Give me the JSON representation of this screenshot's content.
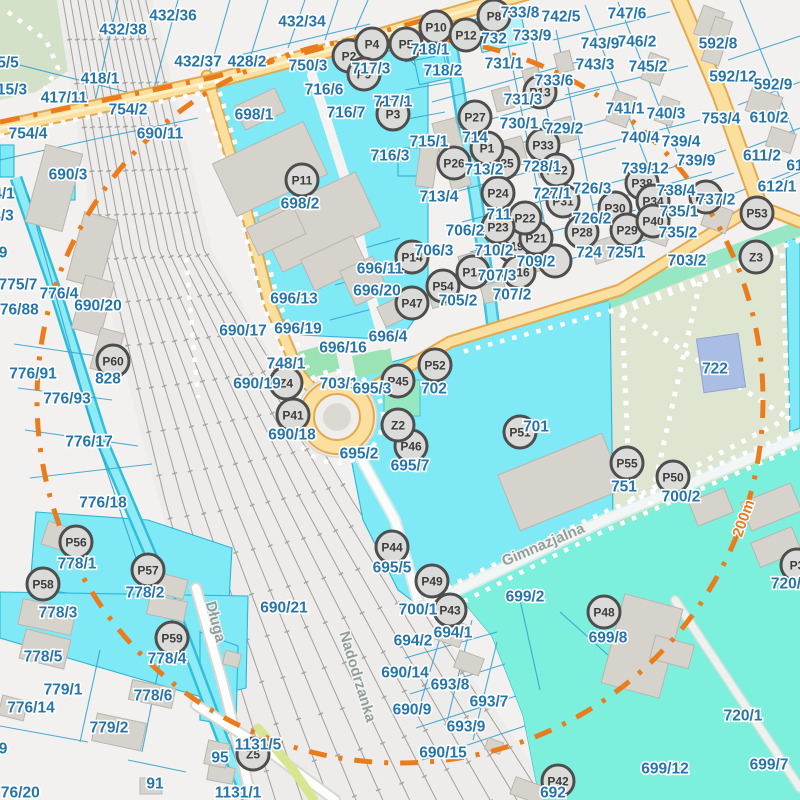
{
  "map": {
    "colors": {
      "background": "#f2f1ef",
      "parcel_cyan": "#7fe9f5",
      "parcel_aqua": "#7cefdd",
      "water_stream": "#8eeaf4",
      "road_yellow": "#fbdf9e",
      "road_casing": "#e5a94e",
      "park_green": "#dee6d2",
      "mint_green": "#97e7c4",
      "building_gray": "#d6d2cc",
      "cadastral_line_blue": "#2f9fca",
      "label_blue": "#2575ab",
      "boundary_orange": "#ea7c1c",
      "marker_fill": "#dbdbda",
      "marker_ring": "#4e4e4e",
      "pond_blue": "#aabde5"
    },
    "street_names": [
      {
        "text": "Długa",
        "x": 211,
        "y": 623,
        "rot": 75
      },
      {
        "text": "Nadodrzanka",
        "x": 353,
        "y": 678,
        "rot": 73
      },
      {
        "text": "Gimnazjalna",
        "x": 545,
        "y": 549,
        "rot": -23
      }
    ],
    "distance_label": {
      "text": "200m",
      "x": 748,
      "y": 520,
      "rot": -70
    },
    "markers": [
      {
        "id": "P2",
        "x": 349,
        "y": 56
      },
      {
        "id": "P4",
        "x": 372,
        "y": 44
      },
      {
        "id": "P5",
        "x": 406,
        "y": 44
      },
      {
        "id": "P8",
        "x": 494,
        "y": 16
      },
      {
        "id": "P10",
        "x": 436,
        "y": 27
      },
      {
        "id": "P12",
        "x": 466,
        "y": 35
      },
      {
        "id": "P9",
        "x": 364,
        "y": 74
      },
      {
        "id": "P3",
        "x": 393,
        "y": 114
      },
      {
        "id": "P11",
        "x": 302,
        "y": 180
      },
      {
        "id": "P13",
        "x": 540,
        "y": 92
      },
      {
        "id": "P27",
        "x": 475,
        "y": 117
      },
      {
        "id": "P33",
        "x": 543,
        "y": 145
      },
      {
        "id": "P26",
        "x": 454,
        "y": 163
      },
      {
        "id": "P25",
        "x": 503,
        "y": 163
      },
      {
        "id": "P1",
        "x": 487,
        "y": 148
      },
      {
        "id": "P32",
        "x": 557,
        "y": 170
      },
      {
        "id": "P24",
        "x": 498,
        "y": 193
      },
      {
        "id": "P31",
        "x": 563,
        "y": 201
      },
      {
        "id": "P14",
        "x": 412,
        "y": 257
      },
      {
        "id": "",
        "x": 555,
        "y": 261
      },
      {
        "id": "P20",
        "x": 528,
        "y": 248
      },
      {
        "id": "P19",
        "x": 513,
        "y": 246
      },
      {
        "id": "P21",
        "x": 536,
        "y": 238
      },
      {
        "id": "P22",
        "x": 525,
        "y": 218
      },
      {
        "id": "P23",
        "x": 498,
        "y": 227
      },
      {
        "id": "P16",
        "x": 519,
        "y": 272
      },
      {
        "id": "P17",
        "x": 473,
        "y": 272
      },
      {
        "id": "P54",
        "x": 443,
        "y": 286
      },
      {
        "id": "P47",
        "x": 412,
        "y": 303
      },
      {
        "id": "P28",
        "x": 582,
        "y": 232
      },
      {
        "id": "P30",
        "x": 615,
        "y": 208
      },
      {
        "id": "P29",
        "x": 627,
        "y": 230
      },
      {
        "id": "P38",
        "x": 642,
        "y": 183
      },
      {
        "id": "P34",
        "x": 653,
        "y": 201
      },
      {
        "id": "P40",
        "x": 653,
        "y": 221
      },
      {
        "id": "P37",
        "x": 706,
        "y": 197
      },
      {
        "id": "P53",
        "x": 757,
        "y": 213
      },
      {
        "id": "P60",
        "x": 113,
        "y": 361
      },
      {
        "id": "P41",
        "x": 293,
        "y": 415
      },
      {
        "id": "P45",
        "x": 398,
        "y": 381
      },
      {
        "id": "P52",
        "x": 435,
        "y": 365
      },
      {
        "id": "P46",
        "x": 411,
        "y": 446
      },
      {
        "id": "P51",
        "x": 520,
        "y": 432
      },
      {
        "id": "P55",
        "x": 627,
        "y": 463
      },
      {
        "id": "P50",
        "x": 673,
        "y": 477
      },
      {
        "id": "P44",
        "x": 392,
        "y": 547
      },
      {
        "id": "P49",
        "x": 432,
        "y": 581
      },
      {
        "id": "P43",
        "x": 450,
        "y": 610
      },
      {
        "id": "P48",
        "x": 604,
        "y": 612
      },
      {
        "id": "P56",
        "x": 76,
        "y": 542
      },
      {
        "id": "P57",
        "x": 148,
        "y": 570
      },
      {
        "id": "P58",
        "x": 43,
        "y": 584
      },
      {
        "id": "P59",
        "x": 172,
        "y": 638
      },
      {
        "id": "P42",
        "x": 558,
        "y": 781
      },
      {
        "id": "P3",
        "x": 797,
        "y": 565
      },
      {
        "id": "Z2",
        "x": 398,
        "y": 425
      },
      {
        "id": "Z3",
        "x": 756,
        "y": 257
      },
      {
        "id": "Z4",
        "x": 286,
        "y": 383
      },
      {
        "id": "Z5",
        "x": 253,
        "y": 754
      }
    ],
    "parcel_labels": [
      {
        "text": "432/38",
        "x": 123,
        "y": 29
      },
      {
        "text": "432/36",
        "x": 173,
        "y": 15
      },
      {
        "text": "432/34",
        "x": 302,
        "y": 21
      },
      {
        "text": "432/37",
        "x": 198,
        "y": 61
      },
      {
        "text": "428/2",
        "x": 247,
        "y": 61
      },
      {
        "text": "418/1",
        "x": 100,
        "y": 78
      },
      {
        "text": "417/11",
        "x": 64,
        "y": 97
      },
      {
        "text": "754/2",
        "x": 128,
        "y": 109
      },
      {
        "text": "754/4",
        "x": 28,
        "y": 133
      },
      {
        "text": "690/11",
        "x": 160,
        "y": 133
      },
      {
        "text": "690/3",
        "x": 68,
        "y": 174
      },
      {
        "text": "5/5",
        "x": 8,
        "y": 62
      },
      {
        "text": "15/3",
        "x": 12,
        "y": 89
      },
      {
        "text": "4/1",
        "x": 4,
        "y": 193
      },
      {
        "text": "8/3",
        "x": 3,
        "y": 215
      },
      {
        "text": "9",
        "x": 3,
        "y": 252
      },
      {
        "text": "775/7",
        "x": 18,
        "y": 284
      },
      {
        "text": "776/4",
        "x": 59,
        "y": 293
      },
      {
        "text": "776/88",
        "x": 15,
        "y": 309
      },
      {
        "text": "690/20",
        "x": 98,
        "y": 305
      },
      {
        "text": "776/91",
        "x": 33,
        "y": 373
      },
      {
        "text": "828",
        "x": 108,
        "y": 378
      },
      {
        "text": "776/93",
        "x": 67,
        "y": 398
      },
      {
        "text": "776/17",
        "x": 89,
        "y": 441
      },
      {
        "text": "776/18",
        "x": 103,
        "y": 502
      },
      {
        "text": "778/1",
        "x": 77,
        "y": 563
      },
      {
        "text": "778/2",
        "x": 145,
        "y": 592
      },
      {
        "text": "778/3",
        "x": 58,
        "y": 612
      },
      {
        "text": "778/5",
        "x": 43,
        "y": 656
      },
      {
        "text": "779/1",
        "x": 63,
        "y": 689
      },
      {
        "text": "776/14",
        "x": 31,
        "y": 707
      },
      {
        "text": "779/2",
        "x": 109,
        "y": 727
      },
      {
        "text": "778/6",
        "x": 153,
        "y": 695
      },
      {
        "text": "778/4",
        "x": 167,
        "y": 658
      },
      {
        "text": "776/20",
        "x": 16,
        "y": 792
      },
      {
        "text": "91",
        "x": 155,
        "y": 783
      },
      {
        "text": "9",
        "x": 3,
        "y": 748
      },
      {
        "text": "95",
        "x": 220,
        "y": 757
      },
      {
        "text": "1131/5",
        "x": 258,
        "y": 744
      },
      {
        "text": "1131/1",
        "x": 238,
        "y": 792
      },
      {
        "text": "698/1",
        "x": 254,
        "y": 114
      },
      {
        "text": "698/2",
        "x": 300,
        "y": 203
      },
      {
        "text": "696/11",
        "x": 380,
        "y": 268
      },
      {
        "text": "696/20",
        "x": 377,
        "y": 290
      },
      {
        "text": "696/13",
        "x": 294,
        "y": 298
      },
      {
        "text": "690/17",
        "x": 243,
        "y": 330
      },
      {
        "text": "696/19",
        "x": 298,
        "y": 328
      },
      {
        "text": "696/16",
        "x": 343,
        "y": 347
      },
      {
        "text": "696/4",
        "x": 388,
        "y": 336
      },
      {
        "text": "748/1",
        "x": 286,
        "y": 363
      },
      {
        "text": "690/19",
        "x": 257,
        "y": 383
      },
      {
        "text": "703/1",
        "x": 339,
        "y": 383
      },
      {
        "text": "695/3",
        "x": 372,
        "y": 388
      },
      {
        "text": "690/18",
        "x": 292,
        "y": 434
      },
      {
        "text": "695/2",
        "x": 359,
        "y": 453
      },
      {
        "text": "695/7",
        "x": 410,
        "y": 465
      },
      {
        "text": "695/5",
        "x": 392,
        "y": 567
      },
      {
        "text": "690/21",
        "x": 284,
        "y": 607
      },
      {
        "text": "690/14",
        "x": 405,
        "y": 672
      },
      {
        "text": "690/9",
        "x": 412,
        "y": 709
      },
      {
        "text": "690/15",
        "x": 443,
        "y": 752
      },
      {
        "text": "694/2",
        "x": 413,
        "y": 640
      },
      {
        "text": "694/1",
        "x": 453,
        "y": 632
      },
      {
        "text": "693/8",
        "x": 450,
        "y": 684
      },
      {
        "text": "693/7",
        "x": 489,
        "y": 701
      },
      {
        "text": "693/9",
        "x": 466,
        "y": 726
      },
      {
        "text": "700/1",
        "x": 418,
        "y": 609
      },
      {
        "text": "702",
        "x": 434,
        "y": 388
      },
      {
        "text": "701",
        "x": 536,
        "y": 426
      },
      {
        "text": "750/3",
        "x": 308,
        "y": 65
      },
      {
        "text": "716/6",
        "x": 324,
        "y": 89
      },
      {
        "text": "716/7",
        "x": 346,
        "y": 112
      },
      {
        "text": "717/3",
        "x": 371,
        "y": 68
      },
      {
        "text": "717/1",
        "x": 393,
        "y": 101
      },
      {
        "text": "716/3",
        "x": 390,
        "y": 155
      },
      {
        "text": "715/1",
        "x": 429,
        "y": 141
      },
      {
        "text": "713/4",
        "x": 439,
        "y": 196
      },
      {
        "text": "713/2",
        "x": 484,
        "y": 169
      },
      {
        "text": "714",
        "x": 475,
        "y": 137
      },
      {
        "text": "718/1",
        "x": 430,
        "y": 49
      },
      {
        "text": "718/2",
        "x": 443,
        "y": 70
      },
      {
        "text": "732",
        "x": 494,
        "y": 38
      },
      {
        "text": "731/1",
        "x": 504,
        "y": 63
      },
      {
        "text": "733/8",
        "x": 520,
        "y": 12
      },
      {
        "text": "733/9",
        "x": 532,
        "y": 35
      },
      {
        "text": "742/5",
        "x": 561,
        "y": 16
      },
      {
        "text": "733/6",
        "x": 554,
        "y": 80
      },
      {
        "text": "731/3",
        "x": 523,
        "y": 99
      },
      {
        "text": "730/1",
        "x": 519,
        "y": 123
      },
      {
        "text": "6",
        "x": 546,
        "y": 124
      },
      {
        "text": "729/2",
        "x": 564,
        "y": 128
      },
      {
        "text": "728/1",
        "x": 542,
        "y": 166
      },
      {
        "text": "727/1",
        "x": 552,
        "y": 193
      },
      {
        "text": "726/3",
        "x": 592,
        "y": 188
      },
      {
        "text": "726/2",
        "x": 592,
        "y": 218
      },
      {
        "text": "724",
        "x": 589,
        "y": 252
      },
      {
        "text": "725/1",
        "x": 626,
        "y": 252
      },
      {
        "text": "711",
        "x": 499,
        "y": 214
      },
      {
        "text": "706/2",
        "x": 465,
        "y": 230
      },
      {
        "text": "706/3",
        "x": 434,
        "y": 250
      },
      {
        "text": "710/2",
        "x": 494,
        "y": 250
      },
      {
        "text": "709/2",
        "x": 536,
        "y": 261
      },
      {
        "text": "707/3",
        "x": 497,
        "y": 275
      },
      {
        "text": "707/2",
        "x": 512,
        "y": 294
      },
      {
        "text": "705/2",
        "x": 458,
        "y": 300
      },
      {
        "text": "747/6",
        "x": 627,
        "y": 13
      },
      {
        "text": "746/2",
        "x": 637,
        "y": 41
      },
      {
        "text": "743/9",
        "x": 600,
        "y": 43
      },
      {
        "text": "743/3",
        "x": 595,
        "y": 64
      },
      {
        "text": "745/2",
        "x": 648,
        "y": 66
      },
      {
        "text": "592/8",
        "x": 718,
        "y": 43
      },
      {
        "text": "592/12",
        "x": 733,
        "y": 76
      },
      {
        "text": "592/9",
        "x": 773,
        "y": 84
      },
      {
        "text": "741/1",
        "x": 625,
        "y": 108
      },
      {
        "text": "740/3",
        "x": 666,
        "y": 113
      },
      {
        "text": "753/4",
        "x": 721,
        "y": 118
      },
      {
        "text": "610/2",
        "x": 769,
        "y": 117
      },
      {
        "text": "740/4",
        "x": 640,
        "y": 137
      },
      {
        "text": "739/4",
        "x": 681,
        "y": 141
      },
      {
        "text": "739/9",
        "x": 696,
        "y": 160
      },
      {
        "text": "611/2",
        "x": 762,
        "y": 155
      },
      {
        "text": "739/12",
        "x": 645,
        "y": 168
      },
      {
        "text": "738/4",
        "x": 676,
        "y": 190
      },
      {
        "text": "737/2",
        "x": 716,
        "y": 199
      },
      {
        "text": "612/1",
        "x": 777,
        "y": 186
      },
      {
        "text": "735/1",
        "x": 679,
        "y": 211
      },
      {
        "text": "735/2",
        "x": 678,
        "y": 232
      },
      {
        "text": "703/2",
        "x": 687,
        "y": 260
      },
      {
        "text": "722",
        "x": 715,
        "y": 368
      },
      {
        "text": "61",
        "x": 795,
        "y": 165
      },
      {
        "text": "751",
        "x": 624,
        "y": 486
      },
      {
        "text": "700/2",
        "x": 681,
        "y": 496
      },
      {
        "text": "720/",
        "x": 786,
        "y": 583
      },
      {
        "text": "699/2",
        "x": 525,
        "y": 596
      },
      {
        "text": "699/8",
        "x": 608,
        "y": 637
      },
      {
        "text": "720/1",
        "x": 743,
        "y": 715
      },
      {
        "text": "699/12",
        "x": 665,
        "y": 768
      },
      {
        "text": "699/7",
        "x": 769,
        "y": 764
      },
      {
        "text": "692",
        "x": 553,
        "y": 792
      }
    ]
  }
}
